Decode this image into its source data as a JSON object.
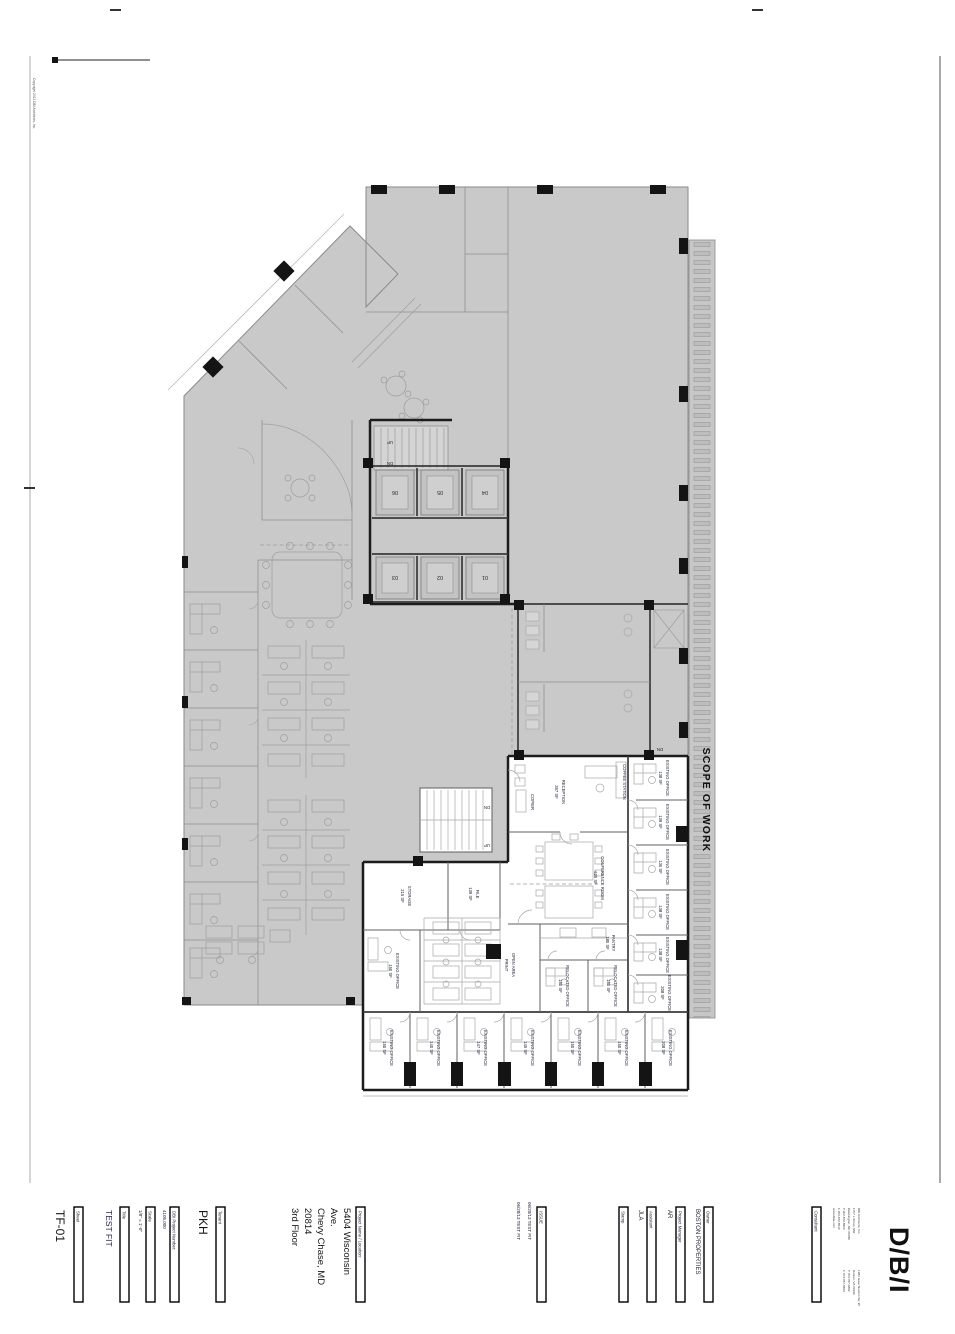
{
  "sheet_marks": {
    "copyright": "Copyright 2013 DBI Architects, Inc."
  },
  "plan": {
    "scope_of_work": "SCOPE OF WORK",
    "stair_up": "UP",
    "stair_dn": "DN",
    "elevators": [
      "06",
      "05",
      "04",
      "03",
      "02",
      "01"
    ],
    "rooms": [
      {
        "name": "RECEPTION",
        "sf": "357 SF"
      },
      {
        "name": "CONFERENCE ROOM",
        "sf": "625 SF"
      },
      {
        "name": "PANTRY",
        "sf": "180 SF"
      },
      {
        "name": "RELOCATED OFFICE",
        "sf": "150 SF"
      },
      {
        "name": "RELOCATED OFFICE",
        "sf": "150 SF"
      },
      {
        "name": "OPEN AREA",
        "sf": "PRINT"
      },
      {
        "name": "STORAGE",
        "sf": "215 SF"
      },
      {
        "name": "FILE",
        "sf": "139 SF"
      },
      {
        "name": "COPIER",
        "sf": ""
      },
      {
        "name": "COFFEE STATION",
        "sf": ""
      },
      {
        "name": "EXISTING OFFICE",
        "sf": "150 SF"
      },
      {
        "name": "EXISTING OFFICE",
        "sf": "138 SF"
      },
      {
        "name": "EXISTING OFFICE",
        "sf": "139 SF"
      },
      {
        "name": "EXISTING OFFICE",
        "sf": "136 SF"
      },
      {
        "name": "EXISTING OFFICE",
        "sf": "138 SF"
      },
      {
        "name": "EXISTING OFFICE",
        "sf": "138 SF"
      },
      {
        "name": "EXISTING OFFICE",
        "sf": "208 SF"
      },
      {
        "name": "EXISTING OFFICE",
        "sf": "150 SF"
      },
      {
        "name": "EXISTING OFFICE",
        "sf": "140 SF"
      },
      {
        "name": "EXISTING OFFICE",
        "sf": "147 SF"
      },
      {
        "name": "EXISTING OFFICE",
        "sf": "145 SF"
      },
      {
        "name": "EXISTING OFFICE",
        "sf": "150 SF"
      },
      {
        "name": "EXISTING OFFICE",
        "sf": "150 SF"
      },
      {
        "name": "EXISTING OFFICE",
        "sf": "208 SF"
      }
    ]
  },
  "title_block": {
    "sheet": {
      "label": "Sheet",
      "value": "TF-01"
    },
    "title": {
      "label": "Title",
      "value": "TEST FIT"
    },
    "scale": {
      "label": "Scale",
      "value": "1/8\" = 1'-0\""
    },
    "project_number": {
      "label": "DBI Project Number:",
      "value": "4105.000"
    },
    "tenant": {
      "label": "Tenant",
      "value": "PKH"
    },
    "project_name": {
      "label": "Project Name / Location:",
      "lines": [
        "5404 Wisconsin",
        "Ave.",
        "Chevy Chase, MD",
        "20814",
        "3rd Floor"
      ]
    },
    "issue": {
      "label": "ISSUE",
      "entries": [
        "06/20/13   TEST FIT",
        "06/28/13   TEST FIT"
      ]
    },
    "stamp": {
      "label": "Stamp"
    },
    "assistant": {
      "label": "Assistant",
      "value": "JLA"
    },
    "project_manager": {
      "label": "Project Manager",
      "value": "AR"
    },
    "owner": {
      "label": "Owner",
      "value": "BOSTON PROPERTIES"
    },
    "consultant": {
      "label": "Consultant",
      "office1": [
        "DBI Architects, Inc.",
        "1707 L Street, NW",
        "Washington, DC 20036",
        "T 202.872.8500",
        "F 202.872.8510",
        "www.dbia.com"
      ],
      "office2": [
        "1984 Isaac Newton Sq. W",
        "Reston, VA 20190",
        "T 703.787.0882",
        "F 703.787.0883"
      ]
    },
    "logo": "D/B/I"
  }
}
